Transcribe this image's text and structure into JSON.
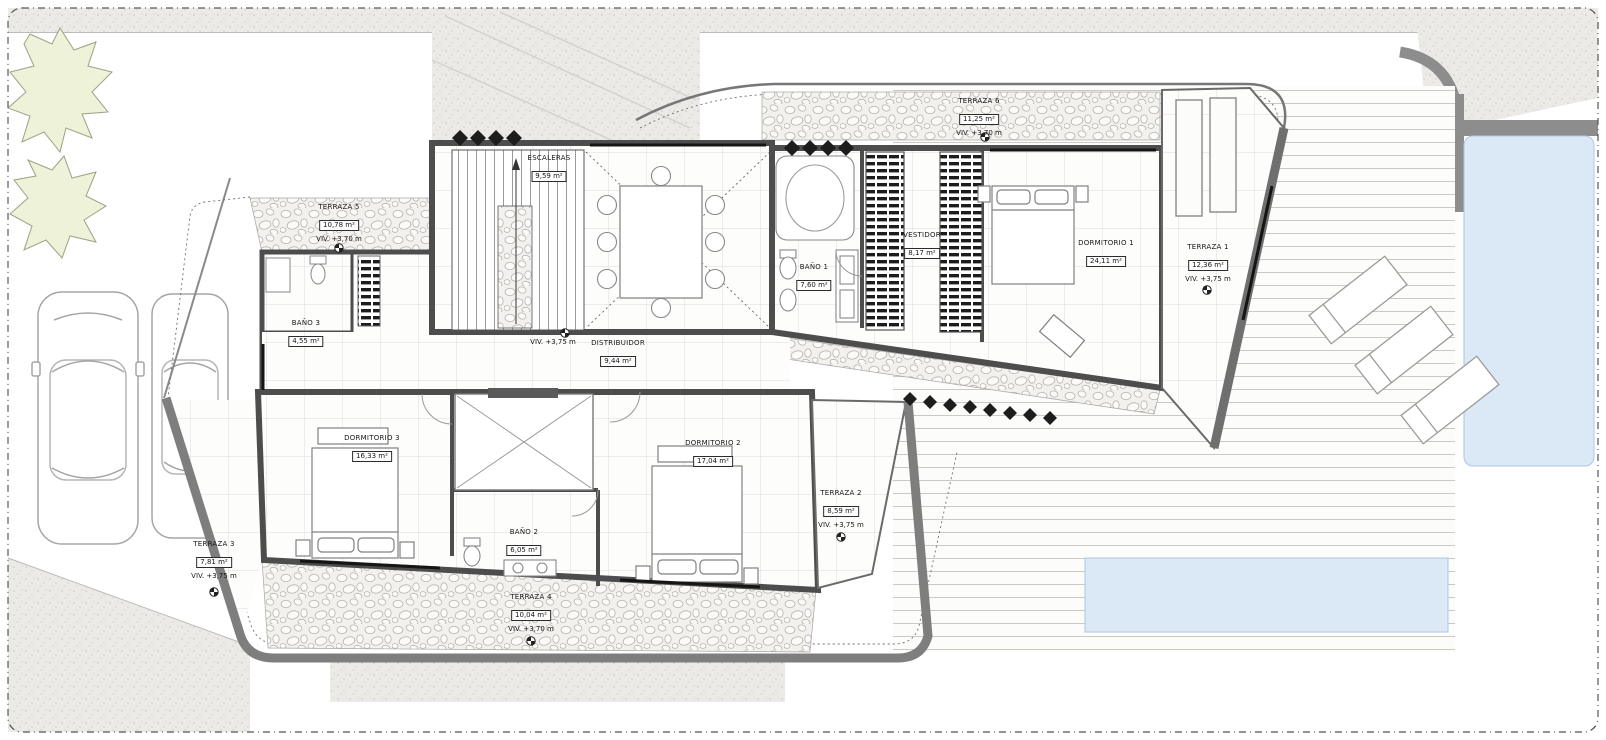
{
  "drawing": {
    "type": "architectural floor plan - upper floor of villa",
    "language": "es",
    "units": "m²"
  },
  "rooms": [
    {
      "name": "ESCALERAS",
      "area": "9,59 m²"
    },
    {
      "name": "TERRAZA 5",
      "area": "10,78 m²",
      "level": "VIV. +3,70 m"
    },
    {
      "name": "TERRAZA 6",
      "area": "11,25 m²",
      "level": "VIV. +3,70 m"
    },
    {
      "name": "BAÑO 1",
      "area": "7,60 m²"
    },
    {
      "name": "VESTIDOR",
      "area": "8,17 m²"
    },
    {
      "name": "DORMITORIO 1",
      "area": "24,11 m²"
    },
    {
      "name": "TERRAZA 1",
      "area": "12,36 m²",
      "level": "VIV. +3,75 m"
    },
    {
      "name": "BAÑO 3",
      "area": "4,55 m²"
    },
    {
      "name": "DISTRIBUIDOR",
      "area": "9,44 m²"
    },
    {
      "name": "DORMITORIO 3",
      "area": "16,33 m²"
    },
    {
      "name": "DORMITORIO 2",
      "area": "17,04 m²"
    },
    {
      "name": "TERRAZA 2",
      "area": "8,59 m²",
      "level": "VIV. +3,75 m"
    },
    {
      "name": "BAÑO 2",
      "area": "6,05 m²"
    },
    {
      "name": "TERRAZA 3",
      "area": "7,81 m²",
      "level": "VIV. +3,75 m"
    },
    {
      "name": "TERRAZA 4",
      "area": "10,04 m²",
      "level": "VIV. +3,70 m"
    }
  ],
  "markers": {
    "hall_level": "VIV. +3,75 m"
  },
  "colors": {
    "wall": "#4d4d4d",
    "retaining_wall": "#7e7e7e",
    "pool_water": "#dbe8f6",
    "paving": "#eceae7",
    "tree_fill": "#edf2d9"
  }
}
